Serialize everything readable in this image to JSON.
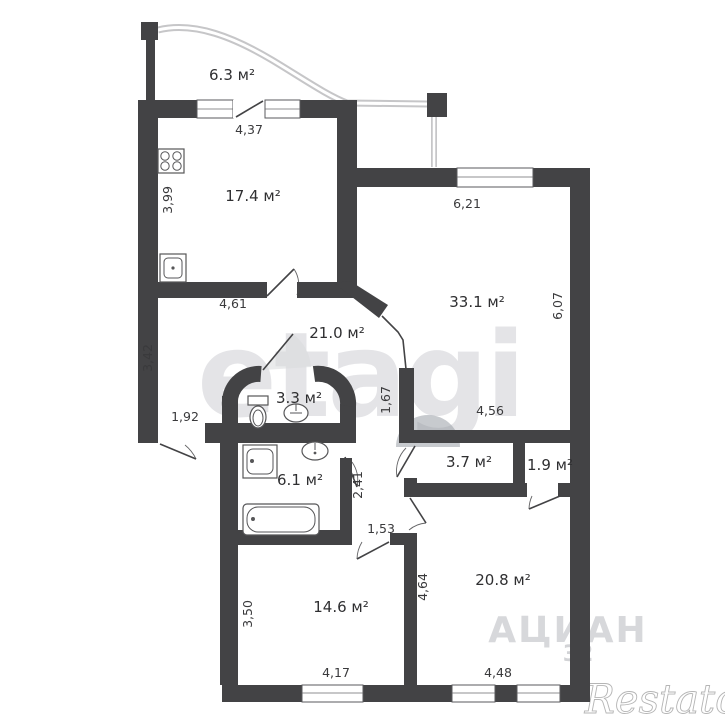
{
  "page": {
    "background": "#ffffff"
  },
  "plan": {
    "wall_color": "#434345",
    "railing_color": "#c6c6c8",
    "label_color": "#2f2f31",
    "rooms": {
      "balcony": "6.3 м²",
      "kitchen": "17.4 м²",
      "living": "33.1 м²",
      "hall": "21.0 м²",
      "wc": "3.3 м²",
      "bathroom": "6.1 м²",
      "storage": "3.7 м²",
      "closet": "1.9 м²",
      "room1": "14.6 м²",
      "room2": "20.8 м²"
    },
    "dims": {
      "balcony_door": "4,37",
      "kitchen_side": "3,99",
      "kitchen_bottom": "4,61",
      "living_top": "6,21",
      "living_side": "6,07",
      "living_bottom": "4,56",
      "hall_side": "3,42",
      "hall_door": "1,92",
      "hall_wall": "1,67",
      "corridor": "2,41",
      "small_hall": "1,53",
      "room1_side": "3,50",
      "room1_bottom": "4,17",
      "room2_side": "4,64",
      "room2_bottom": "4,48"
    }
  },
  "watermarks": {
    "center": "etagi",
    "brand": "АЦИАН",
    "brand_number": "32",
    "corner": "Restato"
  }
}
